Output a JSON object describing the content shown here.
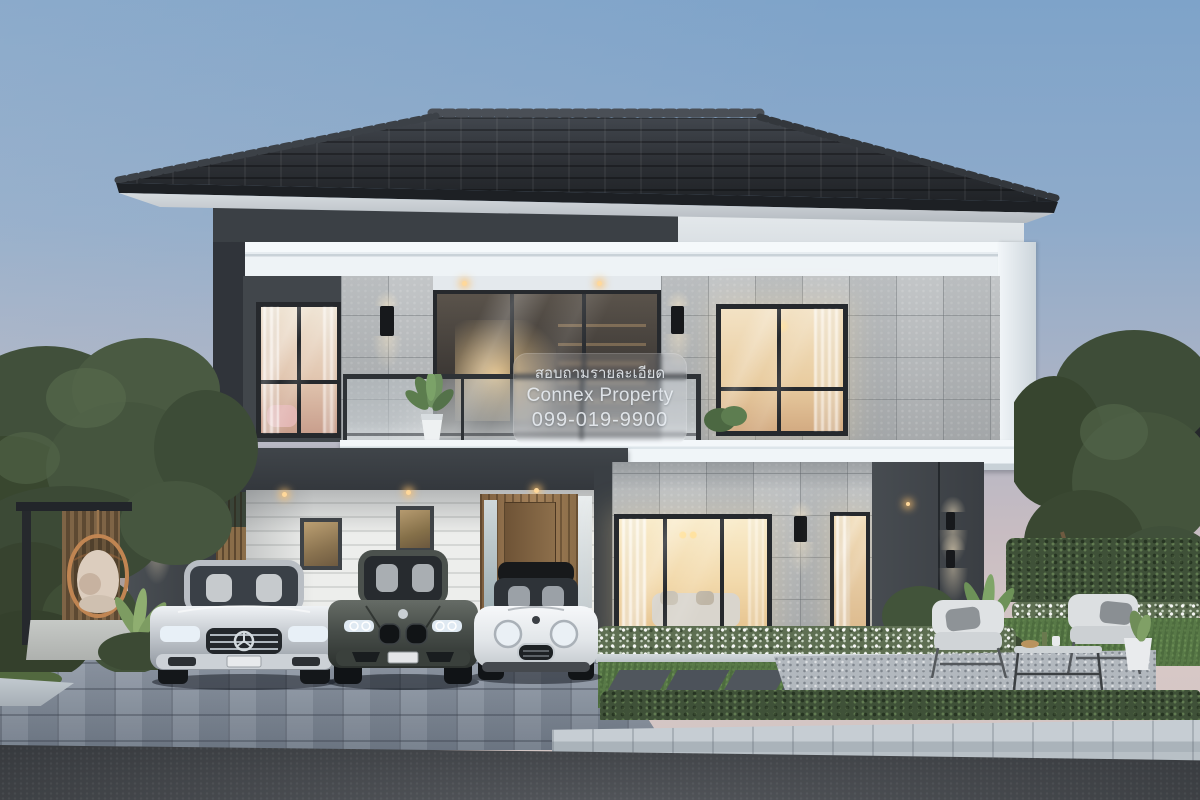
{
  "scene": {
    "description": "Twilight 3D architectural rendering of a modern two-storey detached house with dark hip tile roof, charcoal and grey stone facade, white wrap-around fascia bands, glass-railed balcony, carport with three parked cars, landscaped garden, paver driveway and street foreground",
    "time_of_day": "dusk"
  },
  "watermark": {
    "line1": "สอบถามรายละเอียด",
    "line2": "Connex Property",
    "line3": "099-019-9900"
  },
  "palette": {
    "sky_top": "#7ea3c9",
    "sky_horizon": "#d8c8c6",
    "roof_dark": "#2c2f34",
    "dark_wall": "#3f4449",
    "white_band": "#eef3f7",
    "stone_tile": "#b5b8ba",
    "warm_light": "#f2d9a8",
    "wood_door": "#96744e",
    "lawn": "#587947",
    "paver": "#8f99a6",
    "road": "#404348",
    "car_silver": "#c9cdd2",
    "car_dark_grey": "#4b504c",
    "car_white": "#eef0f2"
  },
  "objects": {
    "vehicles": [
      "silver-luxury-sedan",
      "dark-grey-sport-sedan",
      "white-mini-hatchback"
    ],
    "furniture": [
      "hanging-egg-chair",
      "outdoor-armchair-left",
      "outdoor-armchair-right",
      "coffee-table",
      "white-planter-pot"
    ],
    "lighting": [
      "recessed-warm-downlights",
      "black-wall-sconces"
    ]
  }
}
